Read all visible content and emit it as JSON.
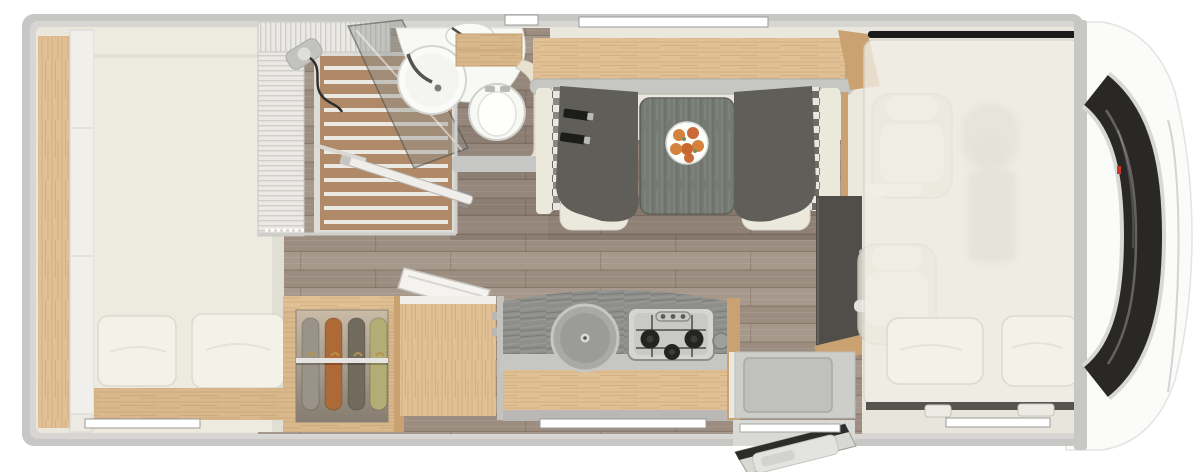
{
  "scene": {
    "type": "motorhome-floor-plan-top-view",
    "orientation": "vehicle front (cab, windshield) at right; rear bedroom at left",
    "areas": [
      {
        "name": "rear-bedroom",
        "items": [
          "double-bed",
          "two-pillows",
          "side-wood-shelf",
          "white-cabinet-column",
          "bed-foot-wood-frame"
        ]
      },
      {
        "name": "bathroom",
        "items": [
          "shower-cabin-pleated-screen",
          "teak-slat-shower-floor",
          "glass-shower-door",
          "round-washbasin",
          "small-vanity-basin",
          "toilet",
          "wood-shelf",
          "open-bathroom-door"
        ]
      },
      {
        "name": "hallway",
        "items": [
          "dark-wood-plank-floor"
        ]
      },
      {
        "name": "wardrobe",
        "items": [
          "clothes-rail",
          "four-hanging-garments"
        ]
      },
      {
        "name": "kitchen",
        "items": [
          "top-loading-compartment-open-lid",
          "round-sink-with-lid",
          "gas-hob-three-burners",
          "wood-drawer-front",
          "counter-backsplash"
        ]
      },
      {
        "name": "dinette",
        "items": [
          "overhead-wood-shelf",
          "left-bench-with-seat-belts",
          "right-bench",
          "gray-table",
          "fruit-plate",
          "checkered-side-panels"
        ]
      },
      {
        "name": "cab",
        "items": [
          "drop-down-bed-translucent",
          "two-bed-pillows",
          "two-ghosted-cab-seats",
          "dashboard-ghost",
          "bed-rail",
          "entry-step",
          "open-entrance-door"
        ]
      },
      {
        "name": "vehicle-front",
        "items": [
          "white-hood",
          "dark-windshield-band",
          "chrome-trim",
          "red-antenna-marker"
        ]
      }
    ],
    "counts": {
      "hob_burners": 3,
      "hanging_garments": 4,
      "fruits_on_plate": 6,
      "rear_bed_pillows": 2,
      "overcab_bed_pillows": 2,
      "wall_windows": 5
    }
  },
  "palette": {
    "background": "#ffffff",
    "wall": "#c7c7c5",
    "wall_light": "#d7d6d3",
    "body_white": "#fbfbf9",
    "interior": "#eae7dd",
    "floor_planks": "#9c8d80",
    "floor_planks_light": "#a6988b",
    "wood": "#e0c094",
    "wood_mid": "#d9b88b",
    "wood_dark": "#caa271",
    "mattress": "#edebdf",
    "pillow": "#f3f1e8",
    "teak": "#b08a68",
    "slat_gap": "#ece9e2",
    "pleat_base": "#eae9e5",
    "pleat_line": "#cfcec8",
    "glass": "#8c8f8c",
    "fixture": "#f8f8f5",
    "seat_dark": "#605e58",
    "seat_cream": "#ebe8dc",
    "check_a": "#e9e7e1",
    "check_b": "#8a8880",
    "check_c": "#b9b6ae",
    "check_d": "#6e6c62",
    "table": "#767c74",
    "plate": "#fdfdfc",
    "fruit": "#d5823f",
    "fruit_leaf": "#7d8b55",
    "splash": "#8e8f8b",
    "counter_edge": "#c6c6c2",
    "sink": "#a9aaa6",
    "hob": "#d5d6d2",
    "burner": "#242422",
    "cabinet_dark": "#4f4e49",
    "step": "#cdcec9",
    "door_panel": "#d8d9d5",
    "door_seal": "#2c2c2a",
    "overcab_bed": "#f1eee5",
    "bed_rail": "#1b1b19",
    "windshield": "#292826",
    "chrome": "#d8d9d5",
    "red_marker": "#c0392b",
    "window": "#ffffff",
    "belt": "#1c1c1a",
    "rail_metal": "#e6e5e1"
  },
  "garments": [
    {
      "name": "garment-gray",
      "color": "#9a9488"
    },
    {
      "name": "garment-rust",
      "color": "#ad6a36"
    },
    {
      "name": "garment-taupe",
      "color": "#716b5d"
    },
    {
      "name": "garment-green",
      "color": "#b2ad75"
    }
  ]
}
